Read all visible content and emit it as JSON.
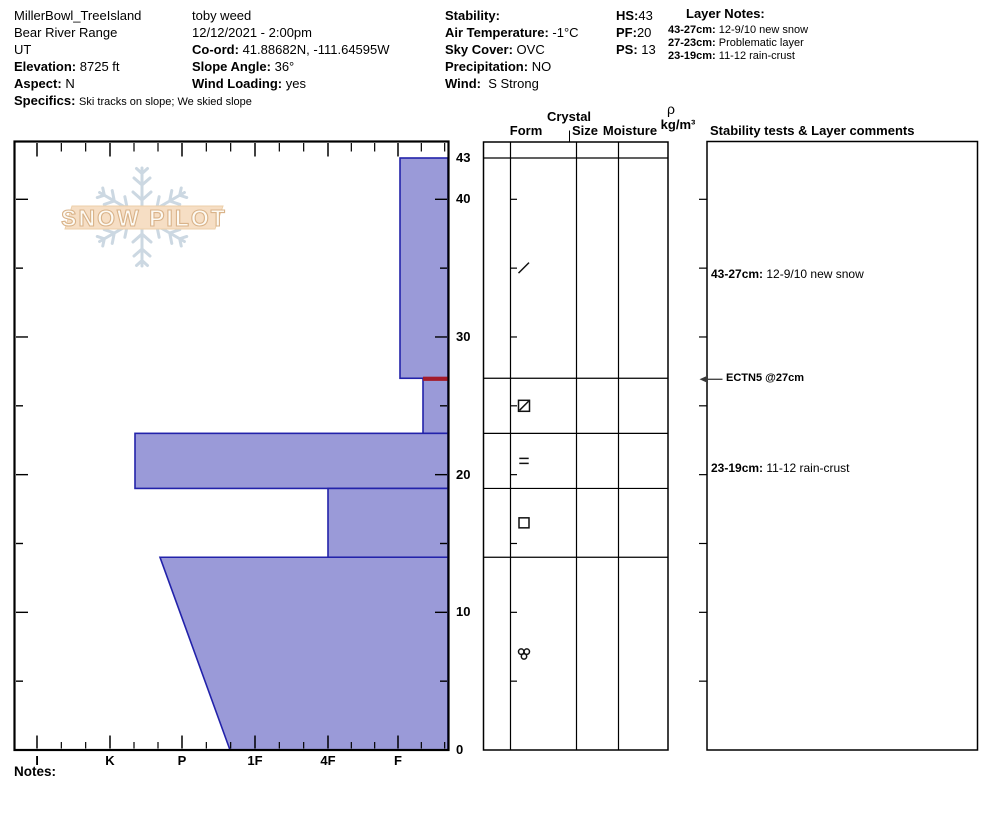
{
  "header": {
    "col1": {
      "site": "MillerBowl_TreeIsland",
      "range": "Bear River Range",
      "state": "UT",
      "elevation_label": "Elevation:",
      "elevation_value": "8725 ft",
      "aspect_label": "Aspect:",
      "aspect_value": "N",
      "specifics_label": "Specifics:",
      "specifics_value": "Ski tracks on slope; We skied slope"
    },
    "col2": {
      "observer": "toby weed",
      "datetime": "12/12/2021 - 2:00pm",
      "coord_label": "Co-ord:",
      "coord_value": "41.88682N, -111.64595W",
      "slope_angle_label": "Slope Angle:",
      "slope_angle_value": "36°",
      "wind_loading_label": "Wind Loading:",
      "wind_loading_value": "yes"
    },
    "col3": {
      "stability_label": "Stability:",
      "air_temp_label": "Air Temperature:",
      "air_temp_value": "-1°C",
      "sky_cover_label": "Sky Cover:",
      "sky_cover_value": "OVC",
      "precip_label": "Precipitation:",
      "precip_value": "NO",
      "wind_label": "Wind:",
      "wind_value": "S Strong"
    },
    "col4": {
      "hs_label": "HS:",
      "hs_value": "43",
      "pf_label": "PF:",
      "pf_value": "20",
      "ps_label": "PS:",
      "ps_value": "13"
    },
    "layer_notes": {
      "heading": "Layer Notes:",
      "items": [
        {
          "label": "43-27cm:",
          "text": "12-9/10 new snow"
        },
        {
          "label": "27-23cm:",
          "text": "Problematic layer"
        },
        {
          "label": "23-19cm:",
          "text": "11-12 rain-crust"
        }
      ]
    }
  },
  "logo": {
    "text": "SNOW PILOT"
  },
  "table_headers": {
    "crystal": "Crystal",
    "form": "Form",
    "size": "Size",
    "moisture": "Moisture",
    "rho": "ρ",
    "rho_units": "kg/m³",
    "comments": "Stability tests & Layer comments"
  },
  "notes_label": "Notes:",
  "chart_data": {
    "type": "bar",
    "title": "Snow hardness profile (depth cm vs hand hardness)",
    "depth_axis": {
      "unit": "cm",
      "min": 0,
      "max": 43,
      "tick_labels": [
        43,
        40,
        30,
        20,
        10,
        0
      ],
      "minor_tick_every_cm": 5
    },
    "hardness_axis": {
      "labels": [
        "I",
        "K",
        "P",
        "1F",
        "4F",
        "F"
      ],
      "x_px": [
        37,
        110,
        182,
        255,
        328,
        398
      ]
    },
    "layers": [
      {
        "from_cm": 43,
        "to_cm": 27,
        "hardness": "F",
        "left_px": 400,
        "comment": "12-9/10 new snow"
      },
      {
        "from_cm": 27,
        "to_cm": 23,
        "hardness": "F-",
        "left_px": 423,
        "problem_layer_top": true,
        "comment": "Problematic layer"
      },
      {
        "from_cm": 23,
        "to_cm": 19,
        "hardness": "K-P",
        "left_px": 135,
        "comment": "11-12 rain-crust"
      },
      {
        "from_cm": 19,
        "to_cm": 14,
        "hardness": "4F",
        "left_px": 328
      },
      {
        "from_cm": 14,
        "to_cm": 0,
        "hardness": "P to P-1F wedge",
        "left_px": 160,
        "left_px_bottom": 230
      }
    ],
    "crystal_forms": [
      {
        "layer": "43-27cm",
        "cm_mid": 35,
        "symbol": "slash-decomposing"
      },
      {
        "layer": "27-23cm",
        "cm_mid": 25,
        "symbol": "square-slashed"
      },
      {
        "layer": "23-19cm",
        "cm_mid": 21,
        "symbol": "equals-crust"
      },
      {
        "layer": "19-14cm",
        "cm_mid": 16.5,
        "symbol": "square-facets"
      },
      {
        "layer": "14-0cm",
        "cm_mid": 7,
        "symbol": "cluster-rounds"
      }
    ],
    "annotations": [
      {
        "kind": "comment",
        "cm": 34.6,
        "label": "43-27cm:",
        "text": "12-9/10 new snow"
      },
      {
        "kind": "test",
        "cm": 27,
        "text": "ECTN5 @27cm"
      },
      {
        "kind": "comment",
        "cm": 20.5,
        "label": "23-19cm:",
        "text": "11-12 rain-crust"
      }
    ],
    "colors": {
      "bar_fill": "#9a9ad8",
      "bar_stroke": "#2222aa",
      "problem_layer_red": "#a31b2a",
      "axis": "#000000",
      "logo_banner": "#f6dec4",
      "logo_banner_stroke": "#eccfa9",
      "logo_letter_fill": "#fdfaf3",
      "logo_letter_stroke": "#d9b38a",
      "logo_flake": "#ccd8e2"
    },
    "layout_hints": {
      "grid": "off",
      "bars_anchor": "right edge = zero hardness",
      "depth_labels_side": "right"
    }
  }
}
